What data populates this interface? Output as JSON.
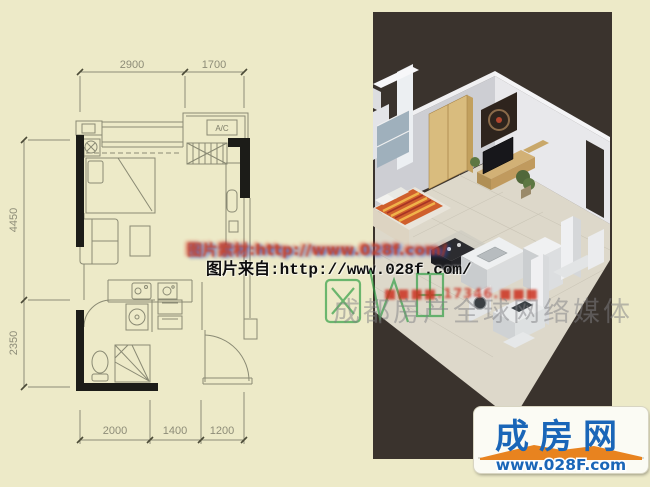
{
  "page": {
    "bg": "#edeac8",
    "panel_bg": "#3a332d"
  },
  "floor_plan": {
    "dims_top": [
      "2900",
      "1700"
    ],
    "dims_left": [
      "4450",
      "2350"
    ],
    "dims_bottom": [
      "2000",
      "1400",
      "1200"
    ],
    "ac_label": "A/C"
  },
  "watermarks": {
    "source_soft": "图片素材:http://www.028f.com/",
    "source_main": "图片来自:http://www.028f.com/",
    "site_red": "■■■■.17346.■■■",
    "media_grey": "成都房产全球网络媒体"
  },
  "logo": {
    "brand": "成房网",
    "url": "www.028F.com",
    "blue": "#1a66b8",
    "navy": "#0c2d5c",
    "orange": "#e8831f"
  }
}
